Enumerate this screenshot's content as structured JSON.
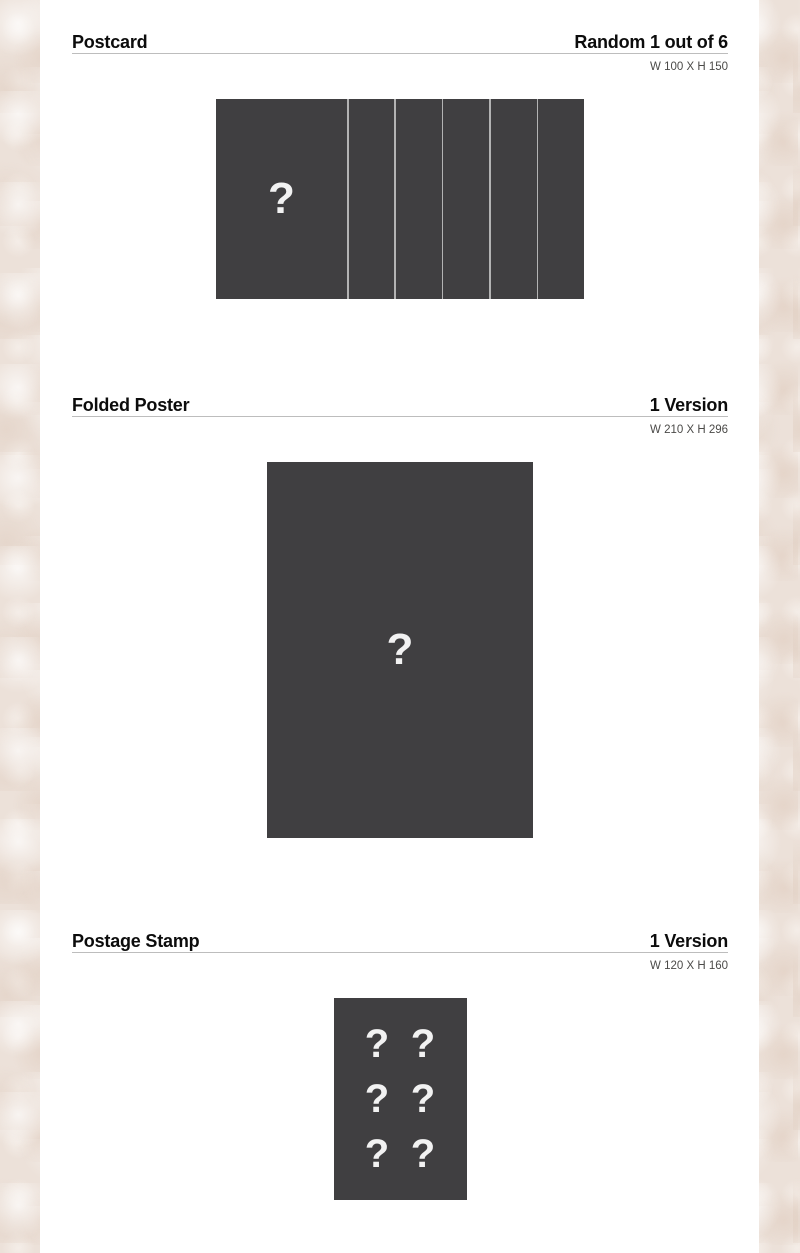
{
  "colors": {
    "page_background": "#ece1d9",
    "content_background": "#ffffff",
    "image_placeholder_dark": "#403f41",
    "placeholder_mark": "#f2f2f2",
    "header_rule": "#bdbdbd",
    "card_divider": "#b3b3b3"
  },
  "sections": [
    {
      "title": "Postcard",
      "count": "Random 1 out of 6",
      "size": "W 100 X H 150",
      "placeholder": "?"
    },
    {
      "title": "Folded Poster",
      "count": "1 Version",
      "size": "W 210 X H 296",
      "placeholder": "?"
    },
    {
      "title": "Postage Stamp",
      "count": "1 Version",
      "size": "W 120 X H 160",
      "placeholder": "?",
      "placeholders": [
        "?",
        "?",
        "?",
        "?",
        "?",
        "?"
      ]
    }
  ]
}
